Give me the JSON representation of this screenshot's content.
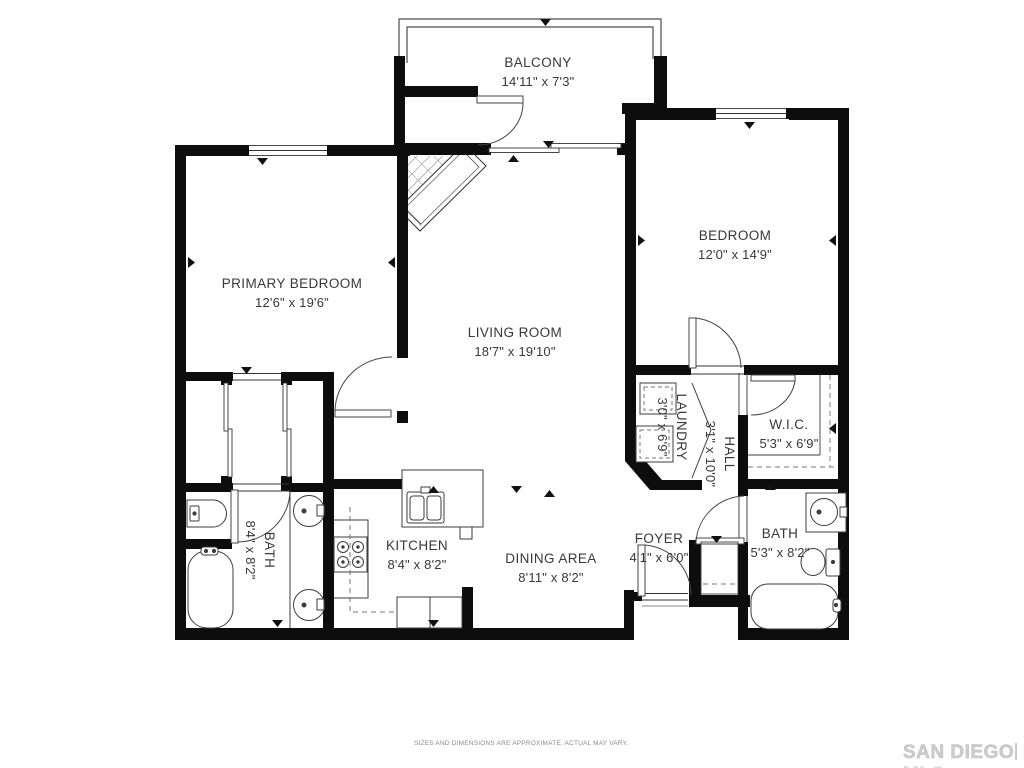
{
  "page": {
    "disclaimer": "SIZES AND DIMENSIONS ARE APPROXIMATE, ACTUAL MAY VARY.",
    "watermark": {
      "brand": "SAN DIEGO",
      "suffix": "MLS"
    }
  },
  "palette": {
    "wall": "#0d0d0d",
    "line": "#3c3c3c",
    "dashed": "#777777",
    "label": "#383838"
  },
  "rooms": {
    "balcony": {
      "name": "BALCONY",
      "dims": "14'11\" x 7'3\""
    },
    "primary_bedroom": {
      "name": "PRIMARY BEDROOM",
      "dims": "12'6\" x 19'6\""
    },
    "bedroom": {
      "name": "BEDROOM",
      "dims": "12'0\" x 14'9\""
    },
    "living_room": {
      "name": "LIVING ROOM",
      "dims": "18'7\" x 19'10\""
    },
    "laundry": {
      "name": "LAUNDRY",
      "dims": "3'0\" x 6'9\""
    },
    "hall": {
      "name": "HALL",
      "dims": "3'1\" x 10'0\""
    },
    "wic": {
      "name": "W.I.C.",
      "dims": "5'3\" x 6'9\""
    },
    "bath_primary": {
      "name": "BATH",
      "dims": "8'4\" x 8'2\""
    },
    "kitchen": {
      "name": "KITCHEN",
      "dims": "8'4\" x 8'2\""
    },
    "dining_area": {
      "name": "DINING AREA",
      "dims": "8'11\" x 8'2\""
    },
    "foyer": {
      "name": "FOYER",
      "dims": "4'1\" x 6'0\""
    },
    "bath_hall": {
      "name": "BATH",
      "dims": "5'3\" x 8'2\""
    }
  }
}
